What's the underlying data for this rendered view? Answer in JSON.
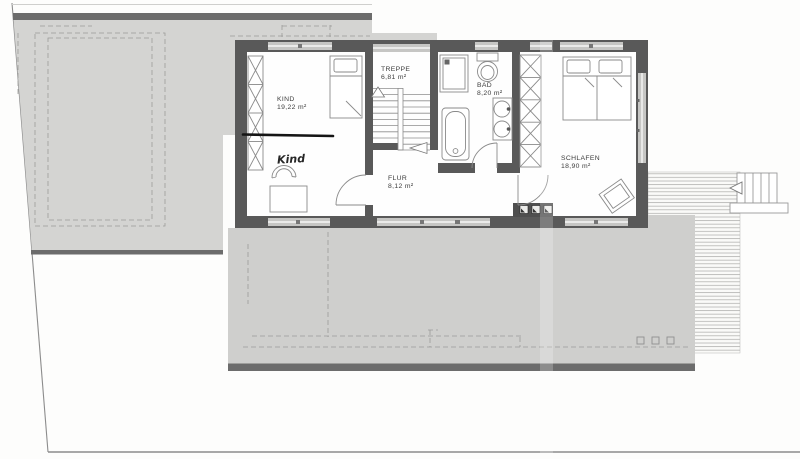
{
  "plan": {
    "rooms": {
      "kind": {
        "label": "KIND",
        "area": "19,22 m²"
      },
      "treppe": {
        "label": "TREPPE",
        "area": "6,81 m²"
      },
      "bad": {
        "label": "BAD",
        "area": "8,20 m²"
      },
      "schlafen": {
        "label": "SCHLAFEN",
        "area": "18,90 m²"
      },
      "flur": {
        "label": "FLUR",
        "area": "8,12 m²"
      }
    },
    "annotations": {
      "handwritten_label": "Kind"
    },
    "colors": {
      "roof_gray_left": "#d4d4d2",
      "roof_gray_lower": "#cfcfcd",
      "edge_band_dark": "#6c6c6c",
      "wall_dark": "#595959",
      "window_band": "#c6c6c4",
      "drawing_line": "#8a8a8a",
      "marker_black": "#151515",
      "background": "#fdfdfc"
    }
  }
}
